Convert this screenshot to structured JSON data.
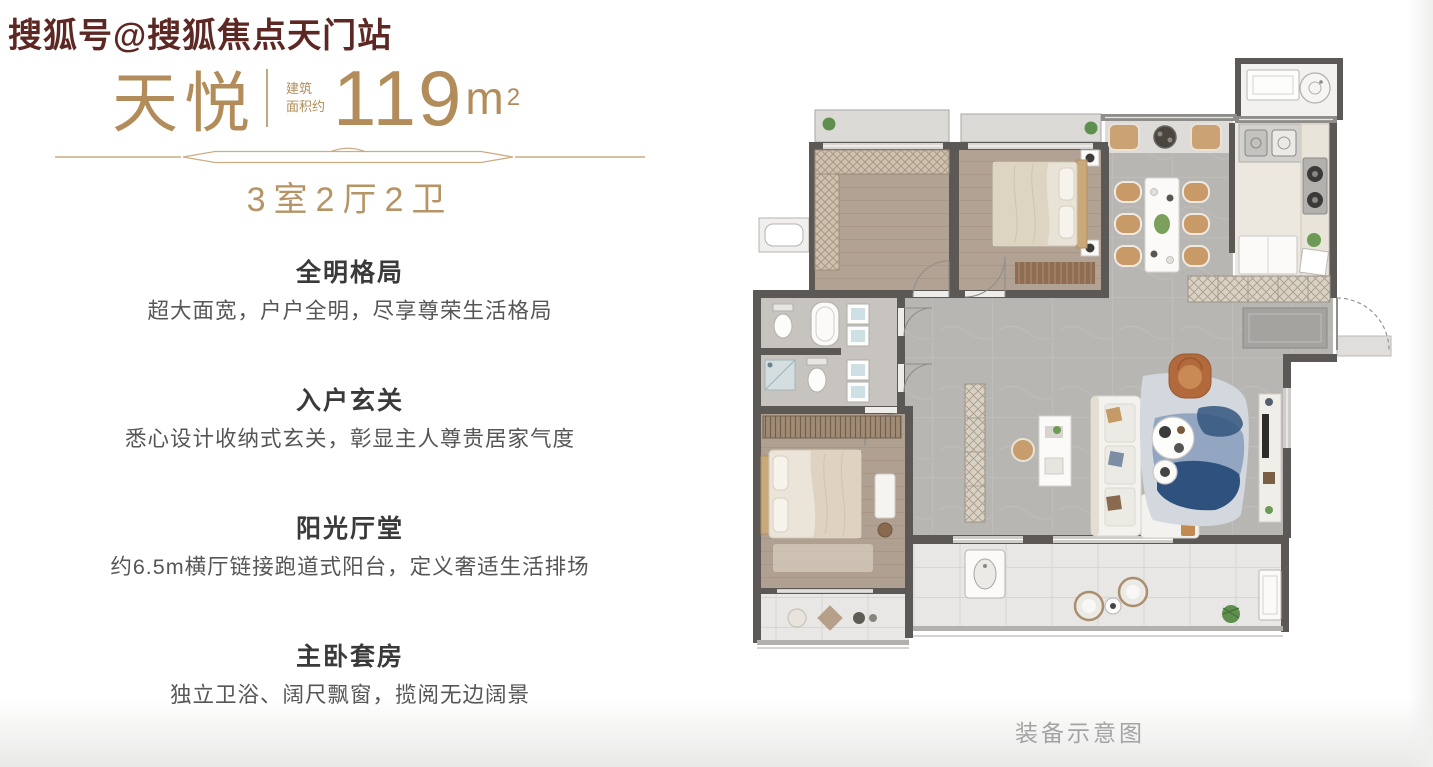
{
  "watermark": {
    "text": "搜狐号@搜狐焦点天门站"
  },
  "title": {
    "name": "天悦",
    "area_label_line1": "建筑",
    "area_label_line2": "面积约",
    "area_number": "119",
    "area_unit": "m",
    "area_exponent": "2",
    "layout_summary": "3室2厅2卫"
  },
  "features": [
    {
      "title": "全明格局",
      "desc": "超大面宽，户户全明，尽享尊荣生活格局"
    },
    {
      "title": "入户玄关",
      "desc": "悉心设计收纳式玄关，彰显主人尊贵居家气度"
    },
    {
      "title": "阳光厅堂",
      "desc": "约6.5m横厅链接跑道式阳台，定义奢适生活排场"
    },
    {
      "title": "主卧套房",
      "desc": "独立卫浴、阔尺飘窗，揽阅无边阔景"
    }
  ],
  "floorplan": {
    "caption": "装备示意图"
  },
  "colors": {
    "gold": "#b28c5a",
    "watermark_red": "#5d2823",
    "heading_dark": "#3a3a3a",
    "body_text": "#565656",
    "caption_gray": "#a3a3a3",
    "wall_dark": "#5b5855",
    "wood_floor": "#b2a294",
    "tile_gray": "#b8b6b3",
    "balcony_floor": "#e8e7e5",
    "rug_blue": "#2f517e",
    "accent_orange": "#b2693b"
  }
}
